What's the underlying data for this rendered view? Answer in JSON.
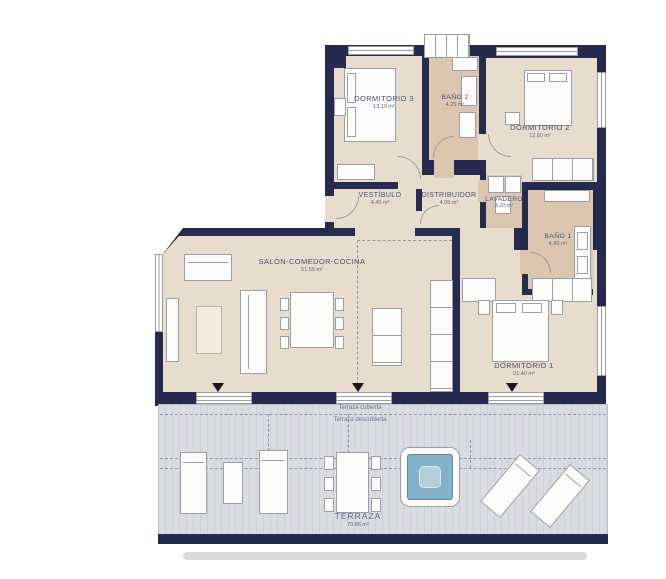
{
  "rooms": [
    {
      "name": "DORMITORIO 3",
      "area": "13.10 m²"
    },
    {
      "name": "BAÑO 2",
      "area": "4.25 m²"
    },
    {
      "name": "DORMITORIO 2",
      "area": "12.80 m²"
    },
    {
      "name": "VESTÍBULO",
      "area": "4.45 m²"
    },
    {
      "name": "DISTRIBUIDOR",
      "area": "4.05 m²"
    },
    {
      "name": "LAVADERO",
      "area": "3.10 m²"
    },
    {
      "name": "BAÑO 1",
      "area": "4.90 m²"
    },
    {
      "name": "SALÓN-COMEDOR-COCINA",
      "area": "51.55 m²"
    },
    {
      "name": "DORMITORIO 1",
      "area": "21.40 m²"
    },
    {
      "name": "TERRAZA",
      "area": "70.86 m²"
    }
  ],
  "terrace": {
    "covered_label": "Terraza cubierta",
    "uncovered_label": "Terraza descubierta"
  },
  "icons": {
    "exit_arrow": "triangle-down"
  },
  "colors": {
    "wall": "#262b4d",
    "floor": "#e8ddcc",
    "bath": "#dcc6b0",
    "terrace": "#dadce1",
    "pool": "#83b2c8",
    "label": "#465072"
  }
}
